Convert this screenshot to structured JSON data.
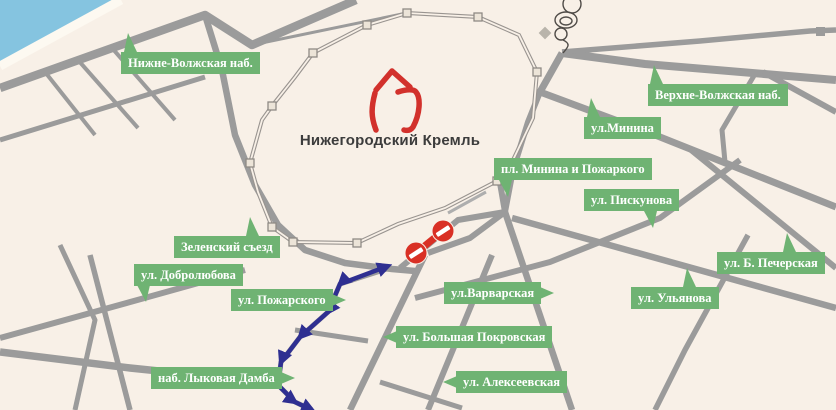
{
  "map": {
    "region_title": "Нижегородский Кремль",
    "street_labels": [
      {
        "id": "nizhne-volzhskaya",
        "text": "Нижне-Волжская наб."
      },
      {
        "id": "verhne-volzhskaya",
        "text": "Верхне-Волжская наб."
      },
      {
        "id": "minina",
        "text": "ул.Минина"
      },
      {
        "id": "pl-minina-pozharskogo",
        "text": "пл. Минина и Пожаркого"
      },
      {
        "id": "piskunova",
        "text": "ул. Пискунова"
      },
      {
        "id": "b-pecherskaya",
        "text": "ул. Б. Печерская"
      },
      {
        "id": "ulyanova",
        "text": "ул. Ульянова"
      },
      {
        "id": "varvarskaya",
        "text": "ул.Варварская"
      },
      {
        "id": "bolshaya-pokrovskaya",
        "text": "ул. Большая Покровская"
      },
      {
        "id": "alekseevskaya",
        "text": "ул. Алексеевская"
      },
      {
        "id": "zelensky-syezd",
        "text": "Зеленский съезд"
      },
      {
        "id": "dobrolyubova",
        "text": "ул. Добролюбова"
      },
      {
        "id": "pozharskogo",
        "text": "ул. Пожарского"
      },
      {
        "id": "lykova-damba",
        "text": "наб. Лыковая Дамба"
      }
    ],
    "no_entry_signs": {
      "count": 2
    },
    "colors": {
      "land": "#f8f0e7",
      "water": "#85c4e0",
      "road": "#9b9b9b",
      "label_green": "#6fb373",
      "label_text": "#ffffff",
      "route_blue": "#2f2f91",
      "sign_red": "#d93025",
      "kremlin_red": "#d2312c",
      "wall_gray": "#999490",
      "title_text": "#3c3c3c"
    }
  }
}
